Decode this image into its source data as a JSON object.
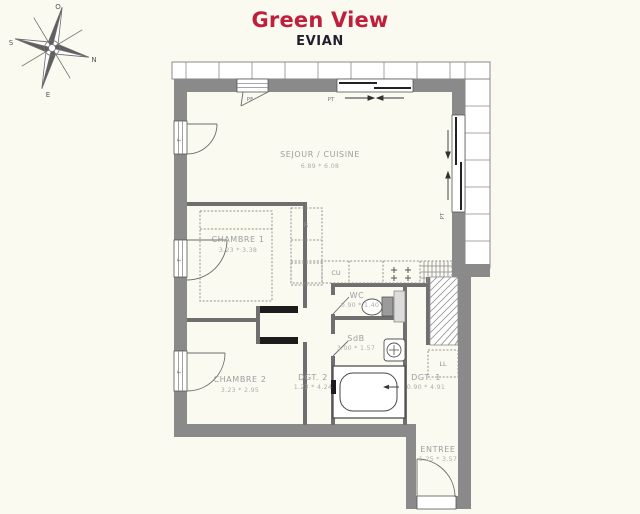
{
  "header": {
    "title": "Green View",
    "subtitle": "EVIAN",
    "title_color": "#bf1e3c"
  },
  "compass": {
    "north": "N",
    "south": "S",
    "east": "E",
    "west": "O"
  },
  "rooms": {
    "sejour": {
      "name": "SEJOUR / CUISINE",
      "dims": "6.89 * 6.08"
    },
    "chambre1": {
      "name": "CHAMBRE 1",
      "dims": "3.23 * 3.38"
    },
    "chambre2": {
      "name": "CHAMBRE 2",
      "dims": "3.23 * 2.95"
    },
    "dgt2": {
      "name": "DGT. 2",
      "dims": "1.23 * 4.24"
    },
    "wc": {
      "name": "WC",
      "dims": "0.90 * 1.40"
    },
    "sdb": {
      "name": "SdB",
      "dims": "3.00 * 1.57"
    },
    "dgt1": {
      "name": "DGT. 1",
      "dims": "0.90 * 4.91"
    },
    "entree": {
      "name": "ENTREE",
      "dims": "1.25 * 3.57"
    }
  },
  "fixtures": {
    "fridge_label": "R",
    "hob_label": "CU",
    "washer_label": "LL",
    "sliding_door_label": "PT",
    "window_label": "F",
    "french_door_label": "PF"
  }
}
